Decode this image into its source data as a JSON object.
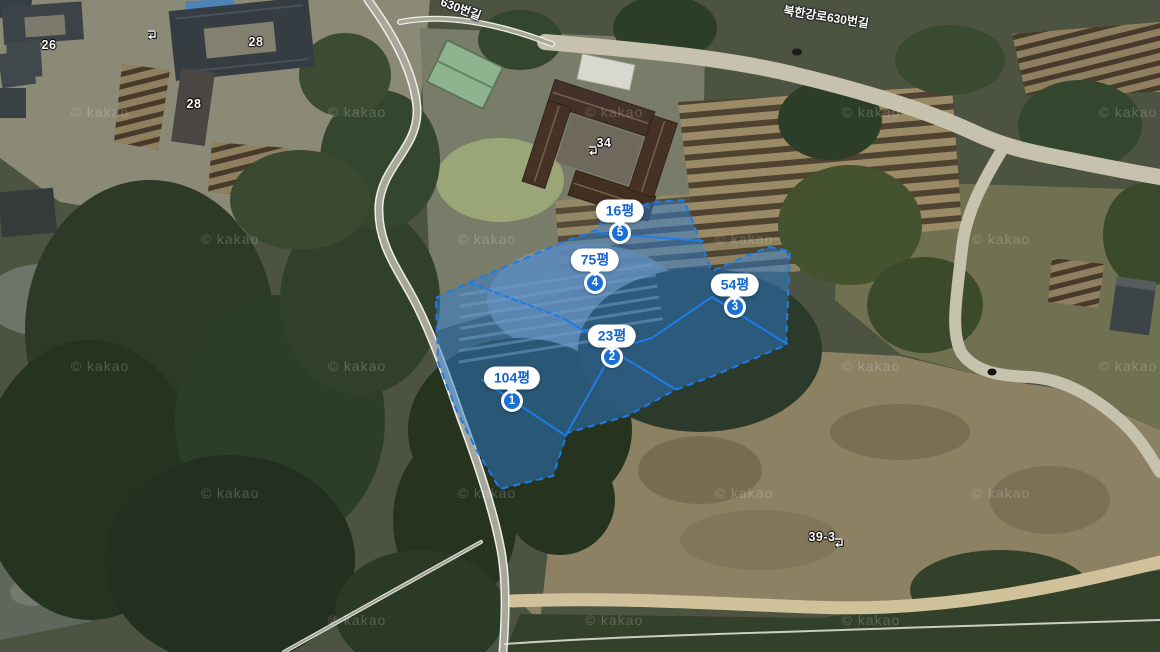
{
  "watermark": {
    "text": "© kakao",
    "positions": [
      [
        100,
        112
      ],
      [
        357,
        112
      ],
      [
        614,
        112
      ],
      [
        871,
        112
      ],
      [
        1128,
        112
      ],
      [
        230,
        239
      ],
      [
        487,
        239
      ],
      [
        744,
        239
      ],
      [
        1001,
        239
      ],
      [
        100,
        366
      ],
      [
        357,
        366
      ],
      [
        871,
        366
      ],
      [
        1128,
        366
      ],
      [
        230,
        493
      ],
      [
        487,
        493
      ],
      [
        744,
        493
      ],
      [
        1001,
        493
      ],
      [
        357,
        620
      ],
      [
        614,
        620
      ],
      [
        871,
        620
      ]
    ]
  },
  "road_labels": [
    {
      "text": "630번길"
    },
    {
      "text": "북한강로630번길"
    }
  ],
  "lot_numbers": [
    {
      "text": "26"
    },
    {
      "text": "28"
    },
    {
      "text": "28"
    },
    {
      "text": "34"
    },
    {
      "text": "39-3"
    }
  ],
  "overlay": {
    "fill_color": "#2d7fd9",
    "border_color": "#1f7ce5",
    "label_text_color": "#1565cf",
    "badge_color": "#1b6fd6",
    "parcels": [
      {
        "number": "1",
        "area_label": "104평"
      },
      {
        "number": "2",
        "area_label": "23평"
      },
      {
        "number": "3",
        "area_label": "54평"
      },
      {
        "number": "4",
        "area_label": "75평"
      },
      {
        "number": "5",
        "area_label": "16평"
      }
    ]
  }
}
